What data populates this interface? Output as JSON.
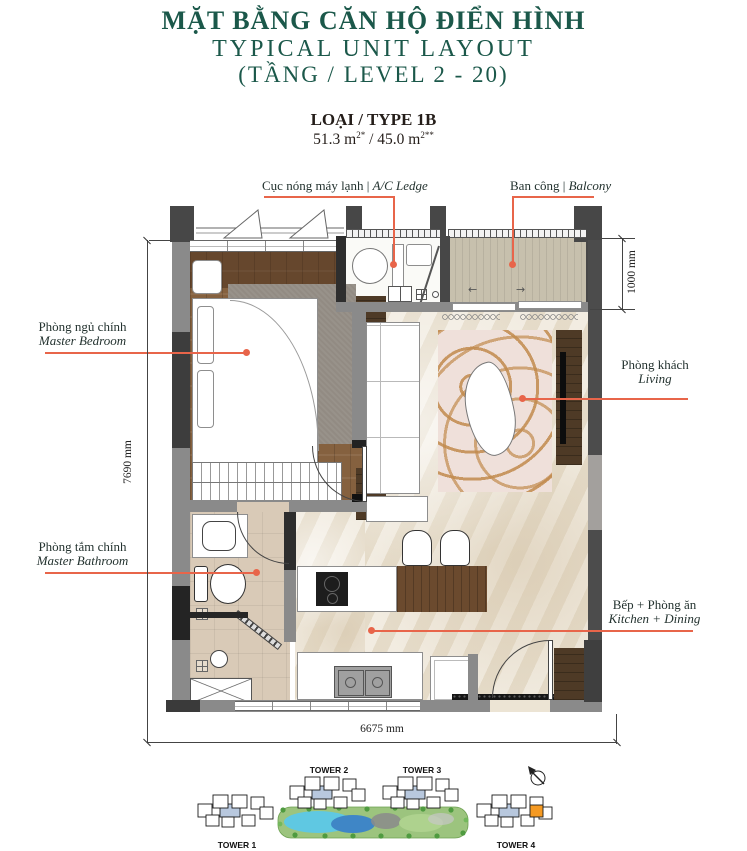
{
  "header": {
    "title_vi": "MẶT BẰNG CĂN HỘ ĐIỂN HÌNH",
    "title_en": "TYPICAL UNIT LAYOUT",
    "title_level": "(TẦNG / LEVEL 2 - 20)"
  },
  "unit": {
    "type_label": "LOẠI / TYPE 1B",
    "area_part1": "51.3 m",
    "area_sup1": "2*",
    "area_part2": " / 45.0 m",
    "area_sup2": "2**"
  },
  "callouts": {
    "ac_ledge": {
      "vi": "Cục nóng máy lạnh",
      "sep": " | ",
      "en": "A/C Ledge"
    },
    "balcony": {
      "vi": "Ban công",
      "sep": " | ",
      "en": "Balcony"
    },
    "master_bedroom": {
      "vi": "Phòng ngủ chính",
      "en": "Master Bedroom"
    },
    "living": {
      "vi": "Phòng khách",
      "en": "Living"
    },
    "master_bathroom": {
      "vi": "Phòng tắm chính",
      "en": "Master Bathroom"
    },
    "kitchen_dining": {
      "vi": "Bếp + Phòng ăn",
      "en": "Kitchen + Dining"
    }
  },
  "dimensions": {
    "overall_width": "6675 mm",
    "overall_depth": "7690 mm",
    "balcony_depth": "1000 mm"
  },
  "site_plan": {
    "towers": [
      {
        "label": "TOWER 1"
      },
      {
        "label": "TOWER 2"
      },
      {
        "label": "TOWER 3"
      },
      {
        "label": "TOWER 4"
      }
    ]
  },
  "colors": {
    "accent_green": "#1b584a",
    "leader_coral": "#e8654a",
    "wall_gray": "#8a8a8a",
    "highlight_orange": "#f59a23",
    "core_blue": "#b8c8de"
  }
}
